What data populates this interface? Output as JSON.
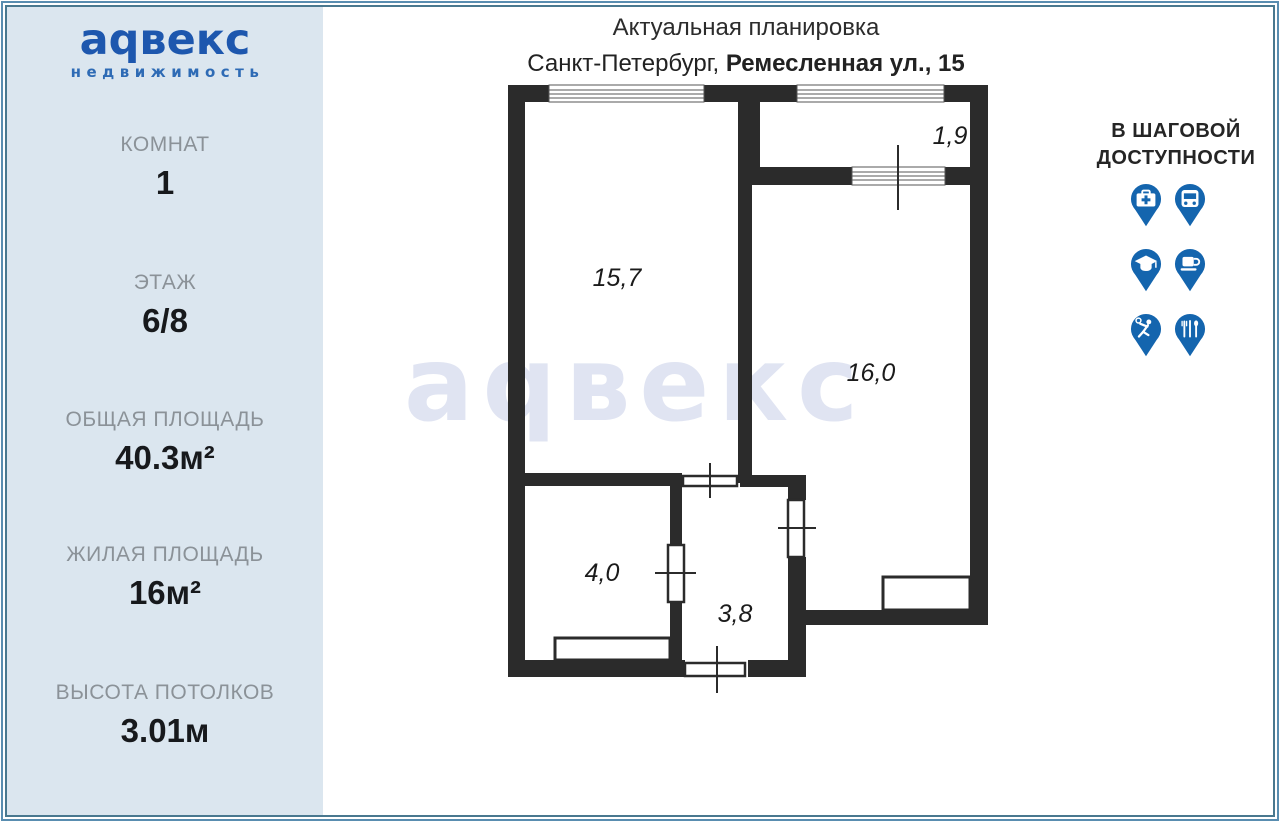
{
  "logo": {
    "brand": "аqвекс",
    "tagline": "недвижимость"
  },
  "sidebar": {
    "stats": [
      {
        "label": "КОМНАТ",
        "value": "1"
      },
      {
        "label": "ЭТАЖ",
        "value": "6/8"
      },
      {
        "label": "ОБЩАЯ ПЛОЩАДЬ",
        "value": "40.3м²"
      },
      {
        "label": "ЖИЛАЯ ПЛОЩАДЬ",
        "value": "16м²"
      },
      {
        "label": "ВЫСОТА ПОТОЛКОВ",
        "value": "3.01м"
      }
    ]
  },
  "header": {
    "title": "Актуальная планировка",
    "subtitle_city": "Санкт-Петербург, ",
    "subtitle_address": "Ремесленная ул., 15"
  },
  "plan": {
    "watermark": "аqвекс",
    "rooms": [
      {
        "name": "living-room",
        "area": "15,7"
      },
      {
        "name": "balcony",
        "area": "1,9"
      },
      {
        "name": "bedroom",
        "area": "16,0"
      },
      {
        "name": "kitchen",
        "area": "4,0"
      },
      {
        "name": "hallway",
        "area": "3,8"
      }
    ]
  },
  "nearby": {
    "title_line1": "В ШАГОВОЙ",
    "title_line2": "ДОСТУПНОСТИ",
    "icons": [
      "medical",
      "bus",
      "education",
      "cafe",
      "sport",
      "restaurant"
    ]
  },
  "colors": {
    "sidebar_bg": "#dbe6ef",
    "logo_blue": "#1d57ae",
    "pin_blue": "#1465ae",
    "wall_dark": "#2b2b2b",
    "watermark": "#e0e4f2",
    "label_gray": "#8b9298"
  }
}
